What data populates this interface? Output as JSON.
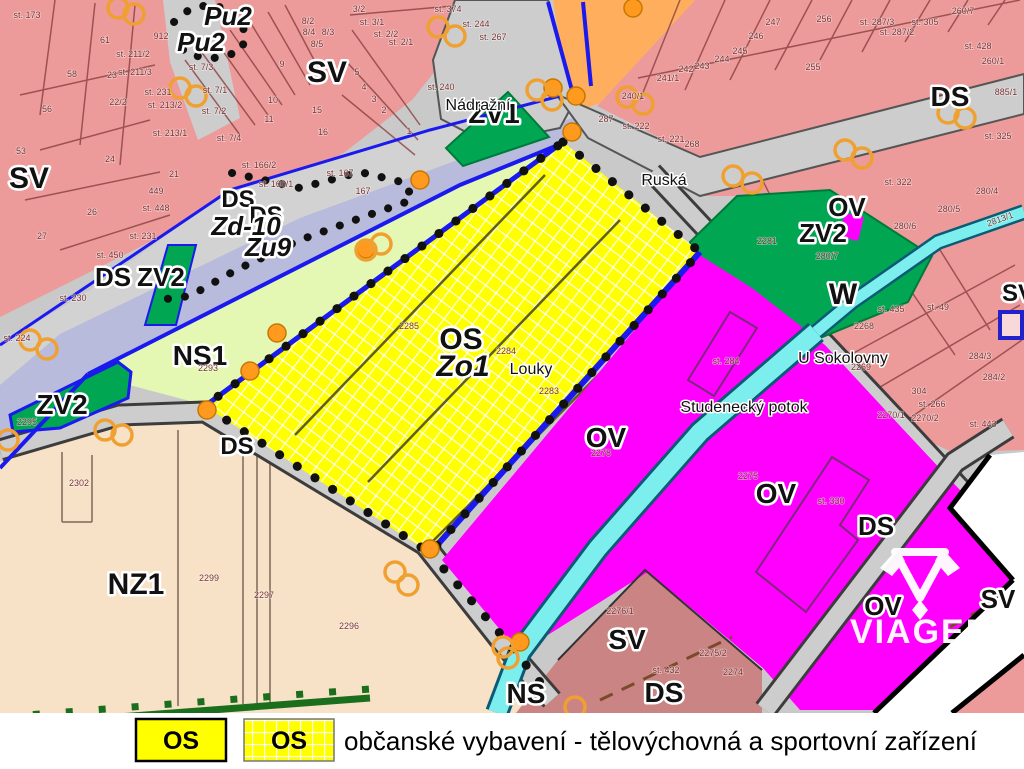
{
  "branding": {
    "logo_text": "VIAGEM"
  },
  "legend": {
    "swatch_solid_label": "OS",
    "swatch_hatched_label": "OS",
    "description": "občanské vybavení - tělovýchovná a sportovní zařízení"
  },
  "colors": {
    "pink": "#ec9a9a",
    "dusty": "#ca8484",
    "yellow": "#ffff00",
    "magenta": "#ff00ff",
    "green": "#00a651",
    "pale_green": "#e4f8b4",
    "cream": "#f7e2c8",
    "orange_zone": "#ffae5e",
    "road": "#cdcdcd",
    "corridor": "#b8bbdb",
    "water": "#7deeee",
    "boundary_blue": "#1a1aee",
    "dot_black": "#111111",
    "marker_orange": "#ff9a1e",
    "legend_yellow": "#ffff00"
  },
  "map": {
    "labels": [
      {
        "t": "SV",
        "x": 29,
        "y": 188,
        "s": 30,
        "cls": "z"
      },
      {
        "t": "Pu2",
        "x": 228,
        "y": 25,
        "s": 26,
        "cls": "z",
        "c": "#2233cc",
        "it": 1
      },
      {
        "t": "Pu2",
        "x": 201,
        "y": 51,
        "s": 26,
        "cls": "z",
        "c": "#2233cc",
        "it": 1
      },
      {
        "t": "SV",
        "x": 327,
        "y": 82,
        "s": 30,
        "cls": "z"
      },
      {
        "t": "ZV1",
        "x": 494,
        "y": 123,
        "s": 28,
        "cls": "z"
      },
      {
        "t": "DS",
        "x": 238,
        "y": 207,
        "s": 24,
        "cls": "z"
      },
      {
        "t": "DS",
        "x": 266,
        "y": 223,
        "s": 24,
        "cls": "z"
      },
      {
        "t": "Zd-10",
        "x": 246,
        "y": 235,
        "s": 26,
        "cls": "z",
        "c": "#cc22cc",
        "it": 1
      },
      {
        "t": "Zu9",
        "x": 268,
        "y": 256,
        "s": 26,
        "cls": "z",
        "c": "#cc22cc",
        "it": 1
      },
      {
        "t": "DS",
        "x": 113,
        "y": 286,
        "s": 26,
        "cls": "z"
      },
      {
        "t": "ZV2",
        "x": 161,
        "y": 286,
        "s": 26,
        "cls": "z"
      },
      {
        "t": "NS1",
        "x": 200,
        "y": 365,
        "s": 28,
        "cls": "z"
      },
      {
        "t": "ZV2",
        "x": 62,
        "y": 414,
        "s": 28,
        "cls": "z"
      },
      {
        "t": "DS",
        "x": 950,
        "y": 106,
        "s": 28,
        "cls": "z"
      },
      {
        "t": "OV",
        "x": 847,
        "y": 216,
        "s": 26,
        "cls": "z"
      },
      {
        "t": "ZV2",
        "x": 823,
        "y": 242,
        "s": 26,
        "cls": "z"
      },
      {
        "t": "W",
        "x": 843,
        "y": 304,
        "s": 30,
        "cls": "z"
      },
      {
        "t": "DS",
        "x": 237,
        "y": 454,
        "s": 24,
        "cls": "z"
      },
      {
        "t": "NZ1",
        "x": 136,
        "y": 594,
        "s": 30,
        "cls": "z"
      },
      {
        "t": "OS",
        "x": 461,
        "y": 349,
        "s": 30,
        "cls": "z"
      },
      {
        "t": "Zo1",
        "x": 463,
        "y": 376,
        "s": 30,
        "cls": "z",
        "c": "#cc22cc",
        "it": 1
      },
      {
        "t": "OV",
        "x": 606,
        "y": 447,
        "s": 28,
        "cls": "z"
      },
      {
        "t": "OV",
        "x": 776,
        "y": 503,
        "s": 28,
        "cls": "z"
      },
      {
        "t": "DS",
        "x": 876,
        "y": 535,
        "s": 26,
        "cls": "z"
      },
      {
        "t": "NS",
        "x": 526,
        "y": 703,
        "s": 28,
        "cls": "z"
      },
      {
        "t": "DS",
        "x": 664,
        "y": 702,
        "s": 28,
        "cls": "z"
      },
      {
        "t": "SV",
        "x": 627,
        "y": 649,
        "s": 28,
        "cls": "z"
      },
      {
        "t": "OV",
        "x": 883,
        "y": 615,
        "s": 26,
        "cls": "z"
      },
      {
        "t": "SV",
        "x": 998,
        "y": 608,
        "s": 26,
        "cls": "z"
      },
      {
        "t": "SV",
        "x": 1018,
        "y": 301,
        "s": 24,
        "cls": "z"
      },
      {
        "t": "Nádražní",
        "x": 478,
        "y": 110,
        "cls": "st"
      },
      {
        "t": "Ruská",
        "x": 664,
        "y": 185,
        "cls": "st"
      },
      {
        "t": "U Sokolovny",
        "x": 843,
        "y": 363,
        "cls": "st"
      },
      {
        "t": "Studenecký potok",
        "x": 744,
        "y": 412,
        "cls": "st",
        "c": "#a333a3"
      },
      {
        "t": "Louky",
        "x": 531,
        "y": 374,
        "s": 19,
        "cls": "st"
      },
      {
        "t": "st. 173",
        "x": 27,
        "y": 18
      },
      {
        "t": "61",
        "x": 105,
        "y": 43
      },
      {
        "t": "58",
        "x": 72,
        "y": 77
      },
      {
        "t": "23",
        "x": 112,
        "y": 78
      },
      {
        "t": "56",
        "x": 47,
        "y": 112
      },
      {
        "t": "22/2",
        "x": 118,
        "y": 105
      },
      {
        "t": "53",
        "x": 21,
        "y": 154
      },
      {
        "t": "24",
        "x": 110,
        "y": 162
      },
      {
        "t": "21",
        "x": 174,
        "y": 177
      },
      {
        "t": "26",
        "x": 92,
        "y": 215
      },
      {
        "t": "27",
        "x": 42,
        "y": 239
      },
      {
        "t": "st. 211/2",
        "x": 133,
        "y": 57
      },
      {
        "t": "st. 211/3",
        "x": 135,
        "y": 75
      },
      {
        "t": "st. 231",
        "x": 158,
        "y": 95
      },
      {
        "t": "st. 213/2",
        "x": 165,
        "y": 108
      },
      {
        "t": "st. 213/1",
        "x": 170,
        "y": 136
      },
      {
        "t": "449",
        "x": 156,
        "y": 194
      },
      {
        "t": "st. 448",
        "x": 156,
        "y": 211
      },
      {
        "t": "st. 231",
        "x": 143,
        "y": 239
      },
      {
        "t": "st. 230",
        "x": 73,
        "y": 301
      },
      {
        "t": "st. 224",
        "x": 17,
        "y": 341
      },
      {
        "t": "st. 450",
        "x": 110,
        "y": 258
      },
      {
        "t": "912",
        "x": 161,
        "y": 39
      },
      {
        "t": "st. 7/3",
        "x": 201,
        "y": 70
      },
      {
        "t": "st. 7/1",
        "x": 215,
        "y": 93
      },
      {
        "t": "st. 7/2",
        "x": 214,
        "y": 114
      },
      {
        "t": "st. 7/4",
        "x": 229,
        "y": 141
      },
      {
        "t": "9",
        "x": 282,
        "y": 67
      },
      {
        "t": "10",
        "x": 273,
        "y": 103
      },
      {
        "t": "11",
        "x": 269,
        "y": 122
      },
      {
        "t": "15",
        "x": 317,
        "y": 113
      },
      {
        "t": "16",
        "x": 323,
        "y": 135
      },
      {
        "t": "8/2",
        "x": 308,
        "y": 24
      },
      {
        "t": "8/4",
        "x": 309,
        "y": 35
      },
      {
        "t": "8/3",
        "x": 328,
        "y": 35
      },
      {
        "t": "8/5",
        "x": 317,
        "y": 47
      },
      {
        "t": "st. 166/2",
        "x": 259,
        "y": 168
      },
      {
        "t": "st. 166/1",
        "x": 276,
        "y": 187
      },
      {
        "t": "3/2",
        "x": 359,
        "y": 12
      },
      {
        "t": "st. 3/1",
        "x": 372,
        "y": 25
      },
      {
        "t": "st. 2/2",
        "x": 386,
        "y": 37
      },
      {
        "t": "st. 2/1",
        "x": 401,
        "y": 45
      },
      {
        "t": "5",
        "x": 357,
        "y": 75
      },
      {
        "t": "4",
        "x": 364,
        "y": 90
      },
      {
        "t": "3",
        "x": 374,
        "y": 102
      },
      {
        "t": "2",
        "x": 384,
        "y": 113
      },
      {
        "t": "1",
        "x": 409,
        "y": 134
      },
      {
        "t": "st. 374",
        "x": 448,
        "y": 12
      },
      {
        "t": "st. 244",
        "x": 476,
        "y": 27
      },
      {
        "t": "st. 267",
        "x": 493,
        "y": 40
      },
      {
        "t": "st. 240",
        "x": 441,
        "y": 90
      },
      {
        "t": "st. 167",
        "x": 340,
        "y": 176
      },
      {
        "t": "167",
        "x": 363,
        "y": 194
      },
      {
        "t": "287",
        "x": 606,
        "y": 122
      },
      {
        "t": "240/1",
        "x": 633,
        "y": 99
      },
      {
        "t": "st. 222",
        "x": 636,
        "y": 129
      },
      {
        "t": "st. 221",
        "x": 671,
        "y": 142
      },
      {
        "t": "268",
        "x": 692,
        "y": 147
      },
      {
        "t": "247",
        "x": 773,
        "y": 25
      },
      {
        "t": "246",
        "x": 756,
        "y": 39
      },
      {
        "t": "245",
        "x": 740,
        "y": 54
      },
      {
        "t": "244",
        "x": 722,
        "y": 62
      },
      {
        "t": "243",
        "x": 702,
        "y": 69
      },
      {
        "t": "242",
        "x": 686,
        "y": 72
      },
      {
        "t": "241/1",
        "x": 668,
        "y": 81
      },
      {
        "t": "255",
        "x": 813,
        "y": 70
      },
      {
        "t": "256",
        "x": 824,
        "y": 22
      },
      {
        "t": "st. 287/3",
        "x": 877,
        "y": 25
      },
      {
        "t": "st. 287/2",
        "x": 897,
        "y": 35
      },
      {
        "t": "st. 305",
        "x": 925,
        "y": 25
      },
      {
        "t": "260/7",
        "x": 963,
        "y": 14
      },
      {
        "t": "st. 428",
        "x": 978,
        "y": 49
      },
      {
        "t": "260/1",
        "x": 993,
        "y": 64
      },
      {
        "t": "885/1",
        "x": 1006,
        "y": 95
      },
      {
        "t": "st. 325",
        "x": 998,
        "y": 139
      },
      {
        "t": "st. 322",
        "x": 898,
        "y": 185
      },
      {
        "t": "280/4",
        "x": 987,
        "y": 194
      },
      {
        "t": "280/5",
        "x": 949,
        "y": 212
      },
      {
        "t": "280/6",
        "x": 905,
        "y": 229
      },
      {
        "t": "280/7",
        "x": 827,
        "y": 259
      },
      {
        "t": "2281",
        "x": 767,
        "y": 244
      },
      {
        "t": "2268",
        "x": 864,
        "y": 329
      },
      {
        "t": "2269",
        "x": 861,
        "y": 370
      },
      {
        "t": "st. 435",
        "x": 891,
        "y": 312
      },
      {
        "t": "st. 49",
        "x": 938,
        "y": 310
      },
      {
        "t": "284/3",
        "x": 980,
        "y": 359
      },
      {
        "t": "284/2",
        "x": 994,
        "y": 380
      },
      {
        "t": "304",
        "x": 919,
        "y": 394
      },
      {
        "t": "st. 266",
        "x": 932,
        "y": 407
      },
      {
        "t": "st. 443",
        "x": 983,
        "y": 427
      },
      {
        "t": "2270/1",
        "x": 891,
        "y": 418
      },
      {
        "t": "2270/2",
        "x": 925,
        "y": 421
      },
      {
        "t": "2813/1",
        "x": 1001,
        "y": 222,
        "r": -20,
        "c": "#2a6a7a"
      },
      {
        "t": "2285",
        "x": 409,
        "y": 329
      },
      {
        "t": "2284",
        "x": 506,
        "y": 354
      },
      {
        "t": "2283",
        "x": 549,
        "y": 394
      },
      {
        "t": "2293",
        "x": 208,
        "y": 371,
        "c": "#667744"
      },
      {
        "t": "2295",
        "x": 27,
        "y": 425,
        "c": "#2b6b3b"
      },
      {
        "t": "st. 284",
        "x": 726,
        "y": 364,
        "c": "#884488"
      },
      {
        "t": "2278",
        "x": 601,
        "y": 456,
        "c": "#aa22aa"
      },
      {
        "t": "2275",
        "x": 748,
        "y": 479,
        "c": "#aa22aa"
      },
      {
        "t": "st. 330",
        "x": 831,
        "y": 504,
        "c": "#884488"
      },
      {
        "t": "2275/2",
        "x": 713,
        "y": 656
      },
      {
        "t": "2274",
        "x": 733,
        "y": 675
      },
      {
        "t": "2302",
        "x": 79,
        "y": 486,
        "c": "#6b5540"
      },
      {
        "t": "2299",
        "x": 209,
        "y": 581,
        "c": "#6b5540"
      },
      {
        "t": "2297",
        "x": 264,
        "y": 598,
        "c": "#6b5540"
      },
      {
        "t": "2296",
        "x": 349,
        "y": 629,
        "c": "#6b5540"
      },
      {
        "t": "2276/1",
        "x": 620,
        "y": 614
      },
      {
        "t": "st. 432",
        "x": 666,
        "y": 673
      }
    ]
  }
}
